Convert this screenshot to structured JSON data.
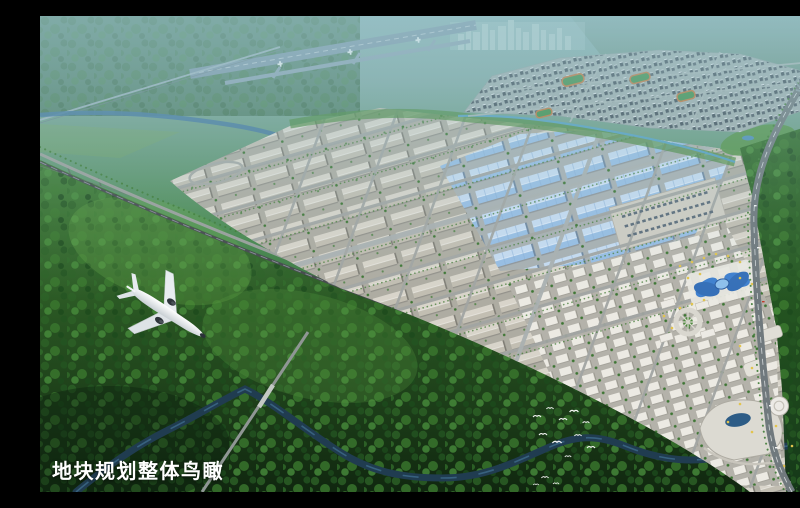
{
  "caption": {
    "text": "地块规划整体鸟瞰"
  },
  "scene": {
    "type": "aerial-masterplan-rendering",
    "elements": {
      "airplane": "white twin-engine airliner banking over forested hills",
      "airport_runway": "hazy runway strip with taxiing aircraft in the distance",
      "distant_city": "faint high-rise skyline on the horizon",
      "residential_district": "dense housing blocks with running-track sports fields",
      "warehouse_grid": "rows of gabled warehouses along tree-lined streets",
      "blue_roof_factories": "large factory halls with light-blue roofs",
      "logistics_yard": "paved truck yard",
      "butterfly_dome": "blue glass butterfly-shaped landmark hall",
      "circular_plaza": "radial commercial plaza",
      "shopping_mall": "curved mall cluster with oval glass roof",
      "highway": "curving boundary expressway with vehicles",
      "boundary_railway": "rail line and road along the south-west park edge",
      "greenbelt_stream": "small stream in a green belt",
      "winding_river": "dark river meandering through forest",
      "bird_flock": "white egrets over the woods",
      "forest": "dense green woodland surrounding the site"
    },
    "palette": {
      "haze": "#8ab2b4",
      "forest_dark": "#132d17",
      "forest_mid": "#3a782e",
      "forest_light": "#5a9c42",
      "warehouse_roof": "#d8d4ca",
      "blue_roof": "#98bee4",
      "road": "#9aa0a3",
      "river": "#203c50",
      "landmark_blue": "#3f80cf",
      "accent_yellow": "#e0c049",
      "caption_text": "#ffffff"
    }
  }
}
